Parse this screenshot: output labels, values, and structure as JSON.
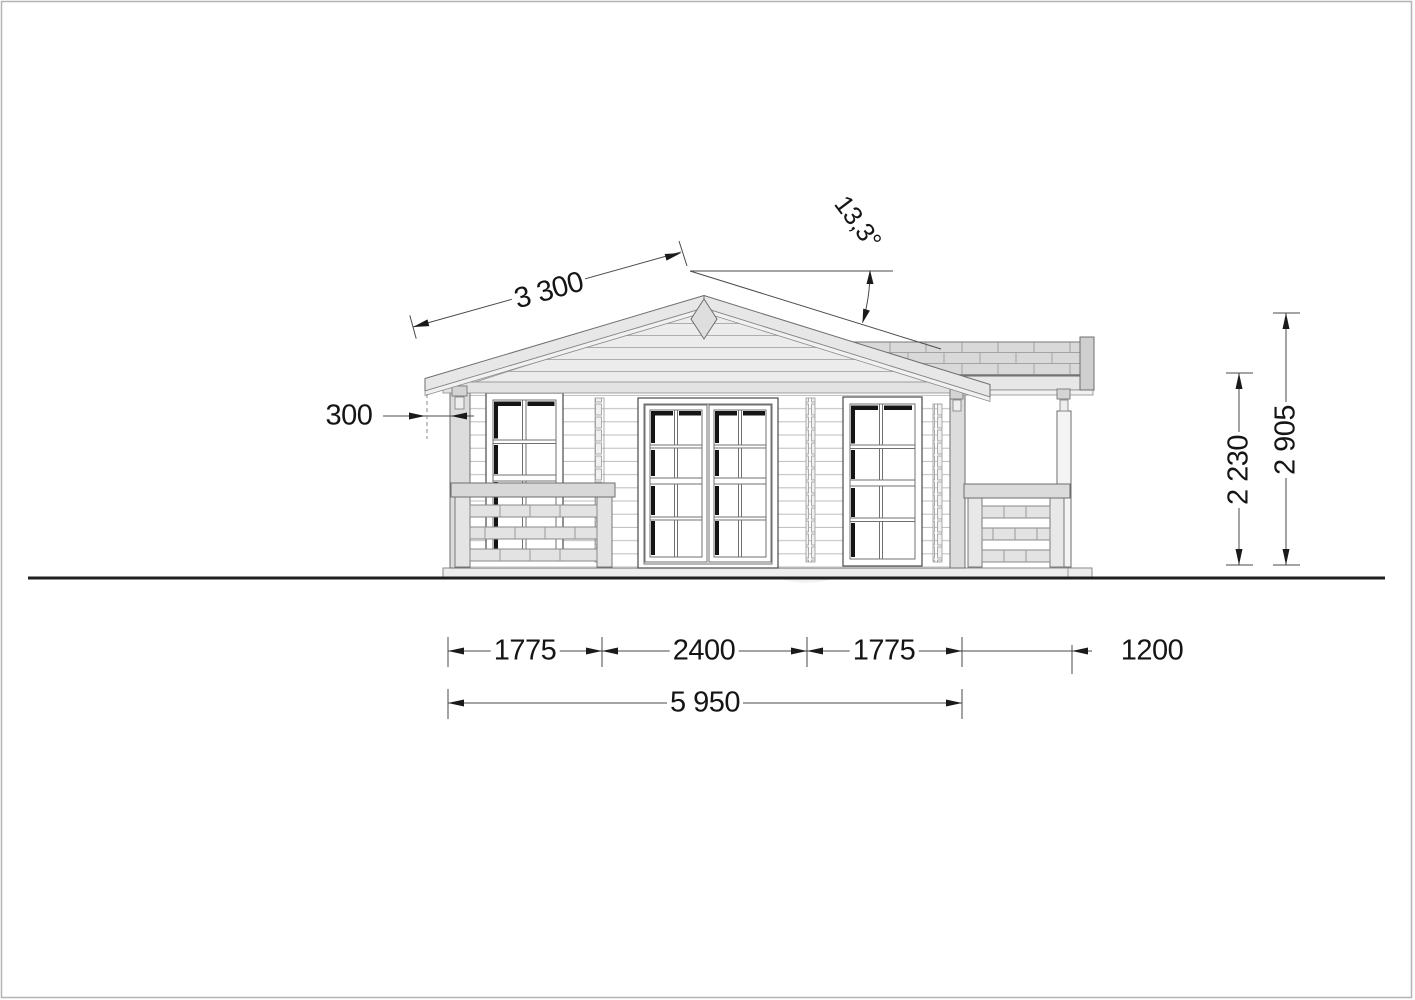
{
  "drawing": {
    "type": "log-cabin side elevation, technical drawing",
    "dimensions": {
      "roof_slope_length": "3 300",
      "roof_angle": "13,3°",
      "roof_overhang": "300",
      "wall_height": "2 230",
      "ridge_height": "2 905",
      "width_left": "1775",
      "width_center": "2400",
      "width_right": "1775",
      "porch_width": "1200",
      "total_width": "5 950"
    },
    "colors": {
      "line_dark": "#3c3c3c",
      "fill_light_gray": "#e8e8e8",
      "background": "#ffffff"
    }
  }
}
